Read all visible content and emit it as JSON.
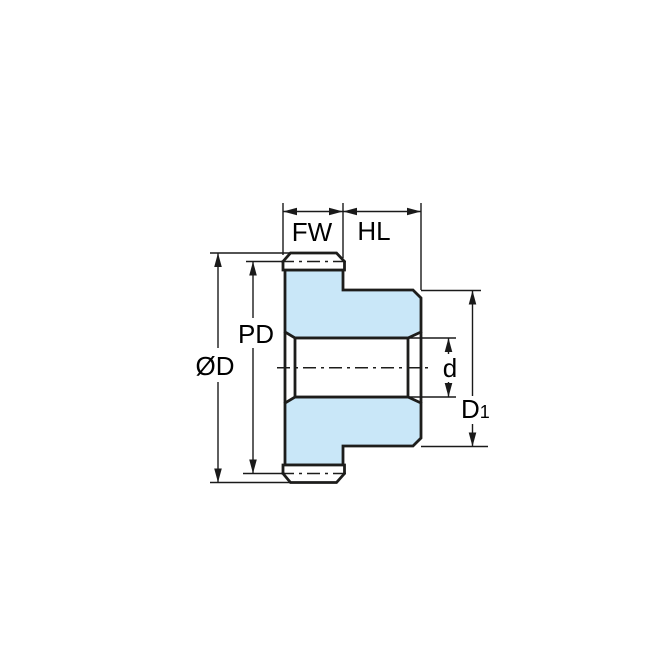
{
  "diagram": {
    "dimension_labels": {
      "face_width": "FW",
      "hub_length": "HL",
      "pitch_diameter": "PD",
      "outside_diameter": "ØD",
      "bore_diameter": "d",
      "hub_diameter": "D",
      "hub_diameter_subscript": "1"
    },
    "colors": {
      "gear_fill": "#c9e7f8",
      "outline": "#1d1d1b",
      "dimension_lines": "#1a1a1a",
      "background": "#ffffff"
    }
  }
}
